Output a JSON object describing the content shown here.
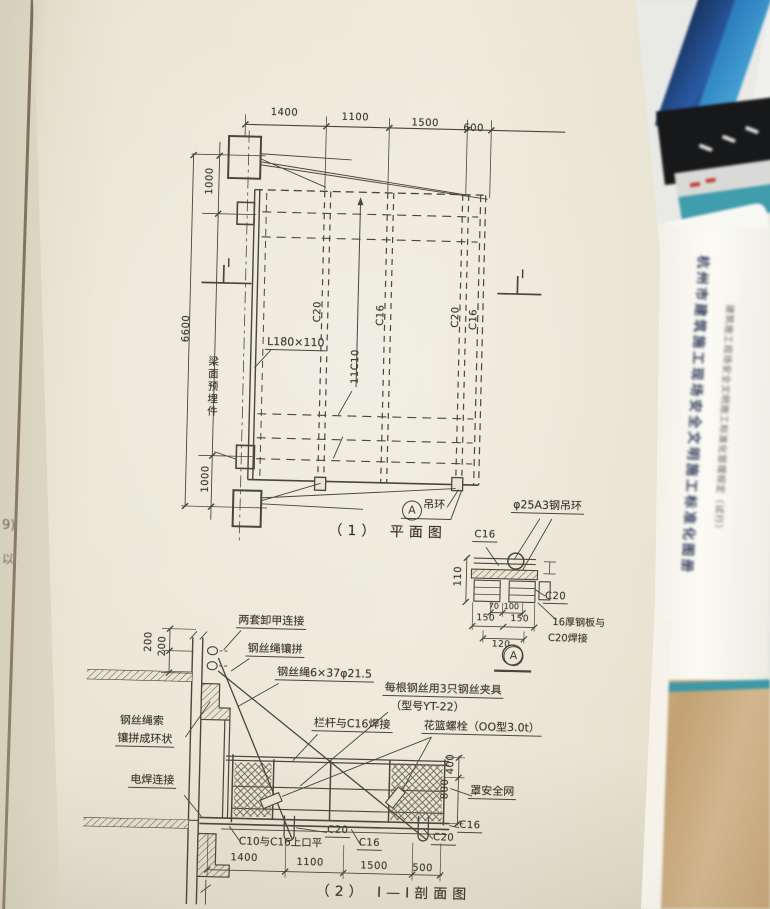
{
  "plan": {
    "caption": "（1） 平面图",
    "dims_top": [
      "1400",
      "1100",
      "1500",
      "600"
    ],
    "dim_1000_top": "1000",
    "dim_6600": "6600",
    "dim_1000_bottom": "1000",
    "angle_label": "L180×110",
    "embed_label": "梁面预埋件",
    "joist_label": "11C10",
    "channel_labels": [
      "C20",
      "C16",
      "C20",
      "C16"
    ],
    "section_mark": "I",
    "ring_label": "吊环",
    "ring_mark": "A"
  },
  "detail": {
    "mark": "A",
    "ring_label": "φ25A3钢吊环",
    "c16": "C16",
    "c20": "C20",
    "weld_line1": "16厚钢板与",
    "weld_line2": "C20焊接",
    "dim_110": "110",
    "dim_70": "70",
    "dim_100": "100",
    "dim_150_left": "150",
    "dim_150_right": "150",
    "dim_120": "120"
  },
  "section": {
    "caption": "（2） I—I剖面图",
    "shackle_label": "两套卸甲连接",
    "splice_label": "钢丝绳镶拼",
    "rope_label": "钢丝绳6×37φ21.5",
    "clamp_line1": "每根钢丝用3只钢丝夹具",
    "clamp_line2": "（型号YT-22）",
    "rail_weld_label": "栏杆与C16焊接",
    "turnbuckle_label": "花篮螺栓（OO型3.0t）",
    "loop_line1": "钢丝绳索",
    "loop_line2": "镶拼成环状",
    "weld_label": "电焊连接",
    "net_label": "罩安全网",
    "dim_200a": "200",
    "dim_200b": "200",
    "dim_400": "400",
    "dim_800": "800",
    "c20_left": "C20",
    "flush_label": "C10与C16上口平",
    "c16_mid": "C16",
    "c20_right": "C20",
    "c16_right": "C16",
    "dims_bottom": [
      "1400",
      "1100",
      "1500",
      "500"
    ]
  },
  "background": {
    "left_fragment_1": "9)",
    "left_fragment_2": "以",
    "side_title": "杭州市建筑施工现场安全文明施工标准化图册",
    "side_subtitle": "建筑施工现场安全文明施工标准化管理规定（试行）"
  }
}
